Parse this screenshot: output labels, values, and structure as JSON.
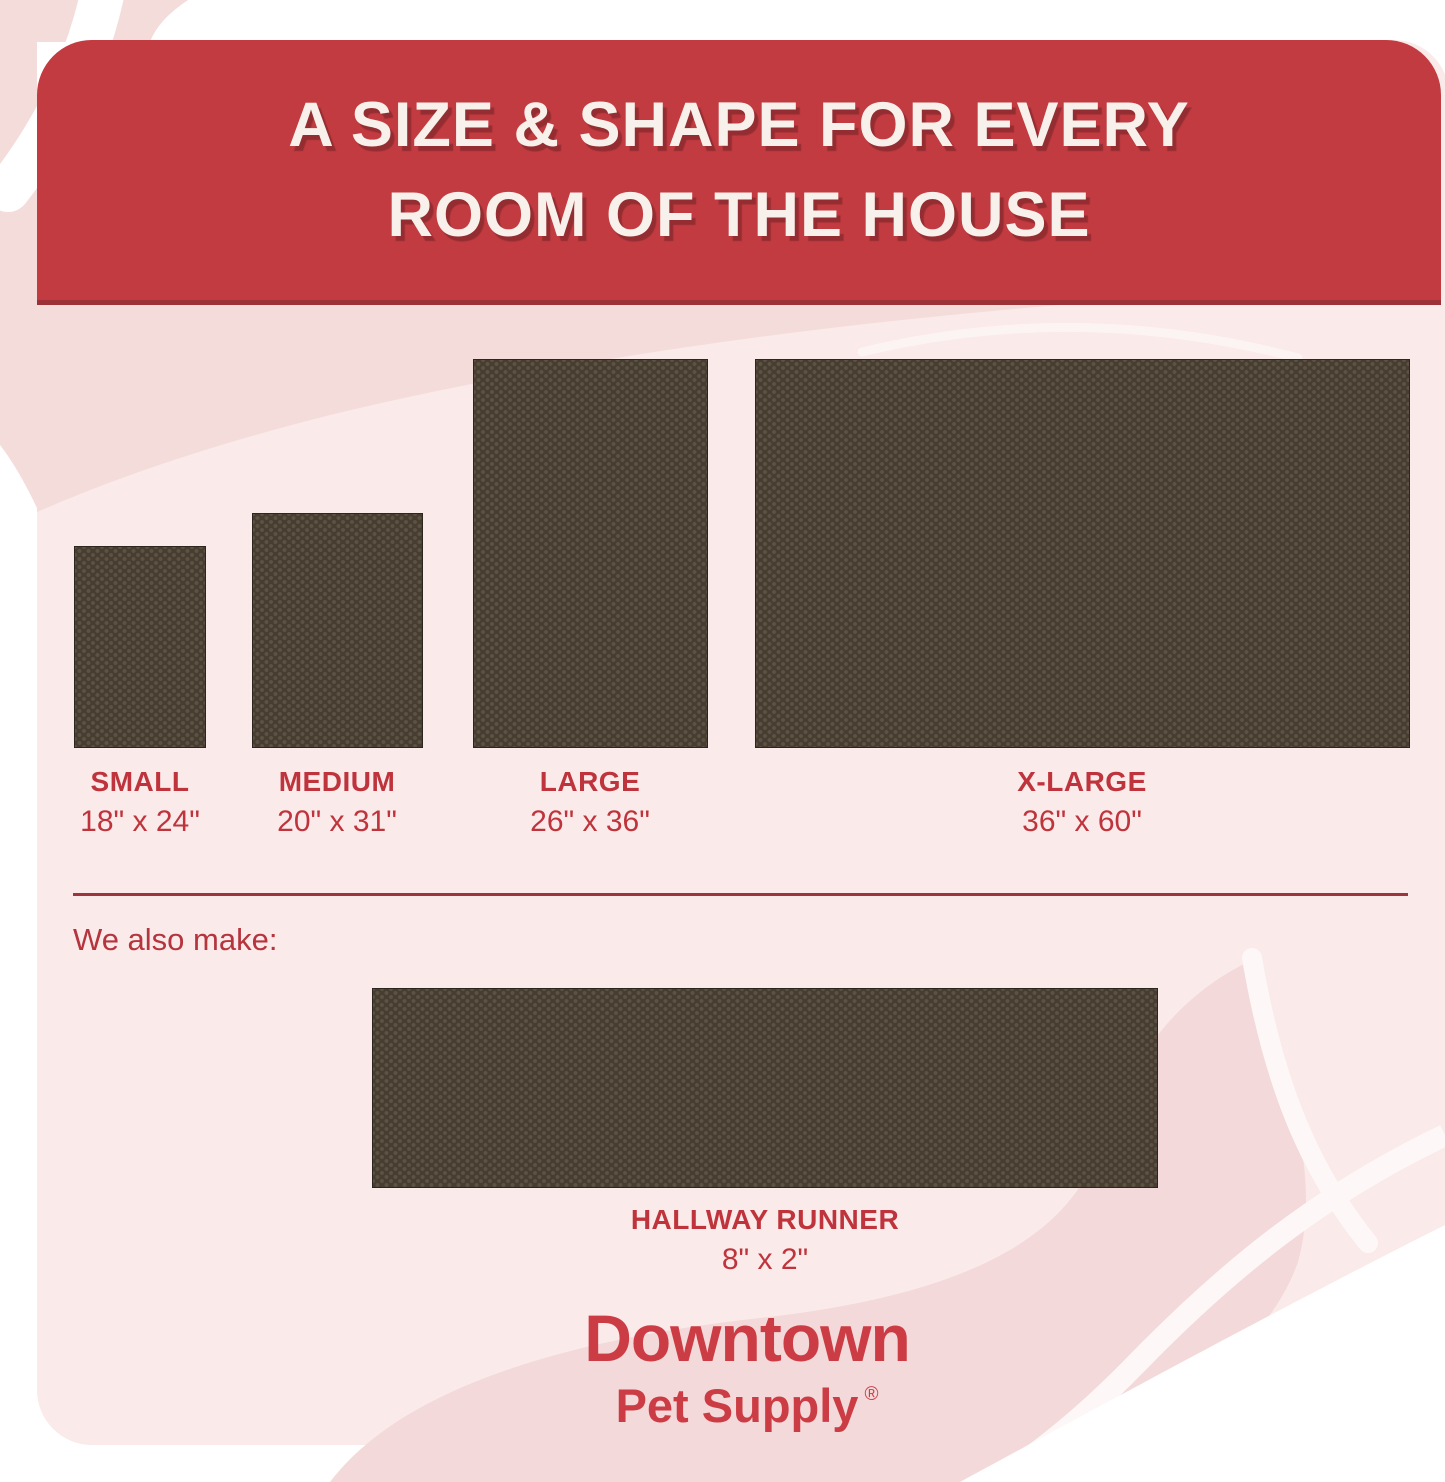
{
  "header": {
    "title_line1": "A SIZE & SHAPE FOR EVERY",
    "title_line2": "ROOM OF THE HOUSE"
  },
  "sizes": [
    {
      "id": "small",
      "name": "SMALL",
      "dimensions": "18\" x 24\""
    },
    {
      "id": "medium",
      "name": "MEDIUM",
      "dimensions": "20\" x 31\""
    },
    {
      "id": "large",
      "name": "LARGE",
      "dimensions": "26\" x 36\""
    },
    {
      "id": "xlarge",
      "name": "X-LARGE",
      "dimensions": "36\" x 60\""
    }
  ],
  "also_make": {
    "label": "We also make:",
    "item": {
      "name": "HALLWAY RUNNER",
      "dimensions": "8\" x 2\""
    }
  },
  "brand": {
    "line1": "Downtown",
    "line2": "Pet Supply",
    "registered": "®"
  },
  "colors": {
    "banner_red": "#c23b41",
    "banner_edge_red": "#9c3138",
    "label_red": "#bf343c",
    "logo_red": "#cc3c45",
    "rug_brown": "#473d31",
    "rug_dot_brown": "#5d5344",
    "panel_pink": "#faeae9",
    "swirl_pink": "#f4dcdb"
  }
}
